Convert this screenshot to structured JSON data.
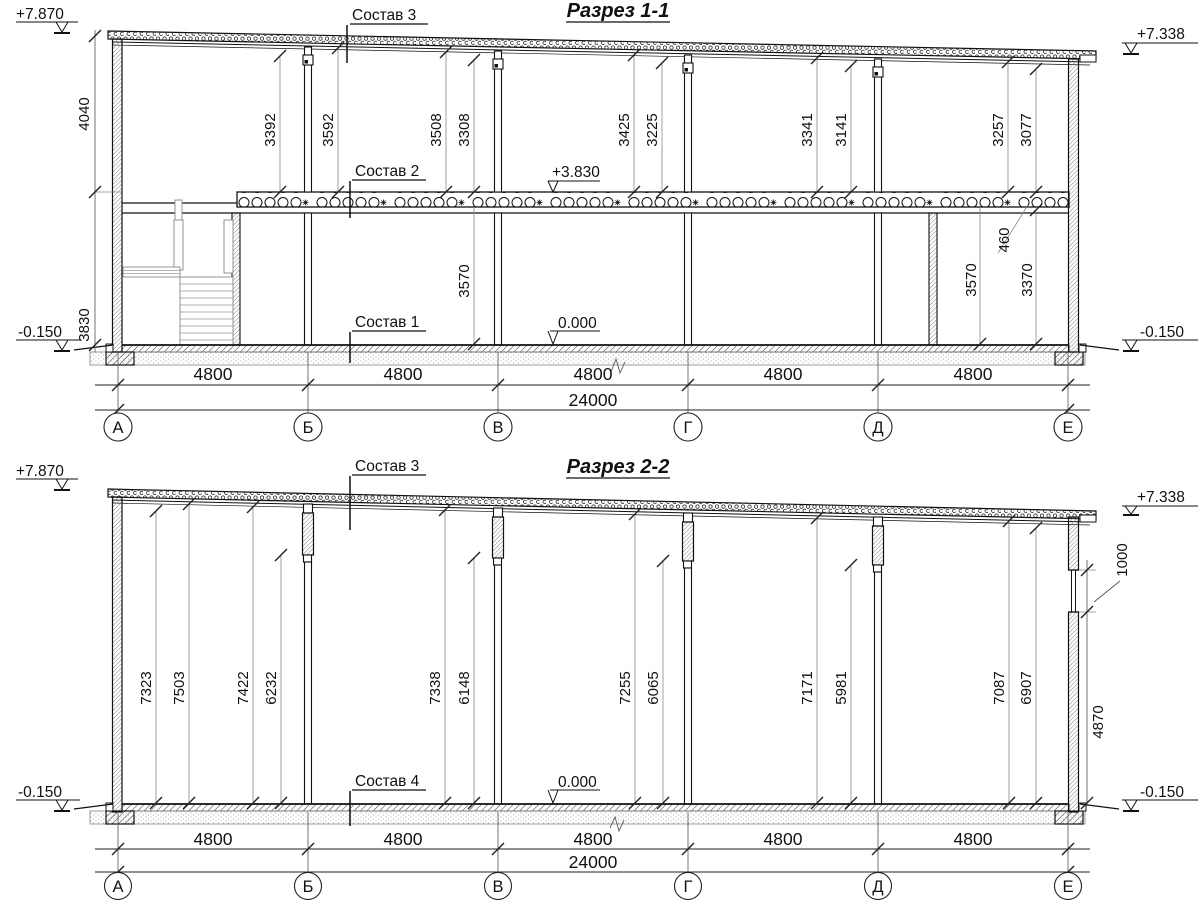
{
  "drawing": {
    "s1": {
      "title": "Разрез 1-1",
      "labels": {
        "l1": "Состав 1",
        "l2": "Состав 2",
        "l3": "Состав 3"
      },
      "elev": {
        "tl": "+7.870",
        "tr": "+7.338",
        "bl": "-0.150",
        "br": "-0.150",
        "slab": "+3.830",
        "floor": "0.000"
      },
      "side": {
        "upper": "4040",
        "lower": "3830"
      },
      "heights": [
        "3392",
        "3592",
        "3508",
        "3308",
        "3425",
        "3225",
        "3341",
        "3141",
        "3257",
        "3077"
      ],
      "lower": {
        "mid": "3570",
        "beam": "460",
        "a": "3570",
        "b": "3370"
      },
      "spans": [
        "4800",
        "4800",
        "4800",
        "4800",
        "4800"
      ],
      "total": "24000",
      "axes": [
        "А",
        "Б",
        "В",
        "Г",
        "Д",
        "Е"
      ]
    },
    "s2": {
      "title": "Разрез 2-2",
      "labels": {
        "l3": "Состав 3",
        "l4": "Состав 4"
      },
      "elev": {
        "tl": "+7.870",
        "tr": "+7.338",
        "bl": "-0.150",
        "br": "-0.150",
        "floor": "0.000"
      },
      "heights": [
        "7323",
        "7503",
        "7422",
        "6232",
        "7338",
        "6148",
        "7255",
        "6065",
        "7171",
        "5981",
        "7087",
        "6907"
      ],
      "right": {
        "window": "1000",
        "below": "4870"
      },
      "spans": [
        "4800",
        "4800",
        "4800",
        "4800",
        "4800"
      ],
      "total": "24000",
      "axes": [
        "А",
        "Б",
        "В",
        "Г",
        "Д",
        "Е"
      ]
    }
  }
}
